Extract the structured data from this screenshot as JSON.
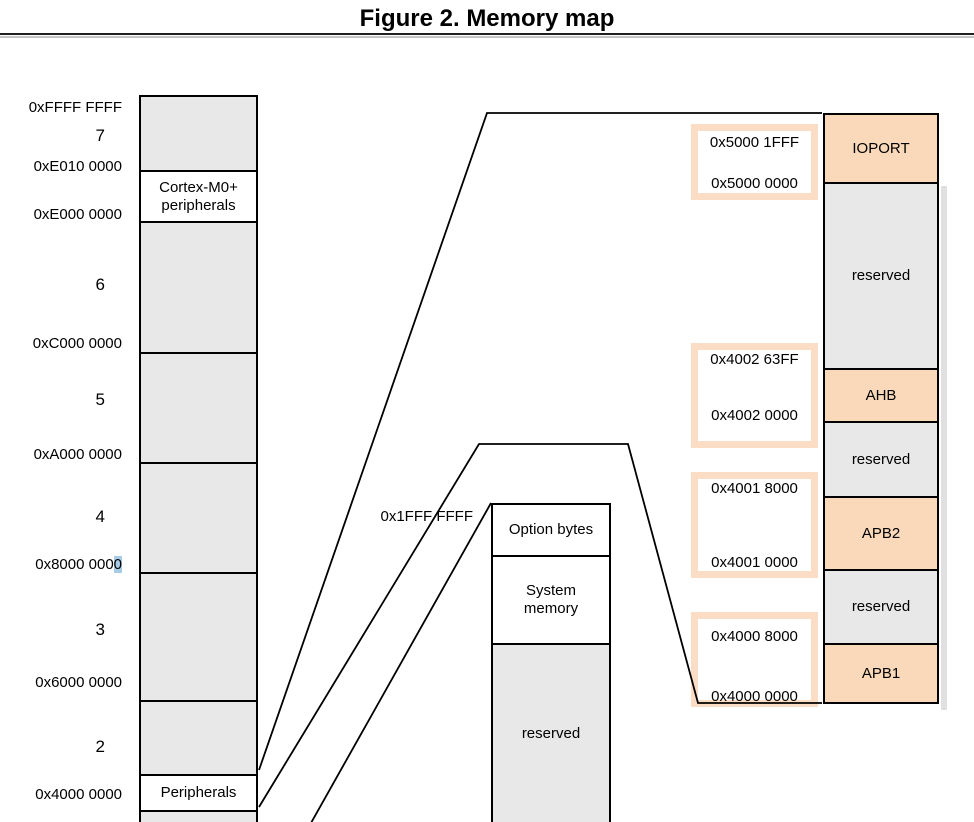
{
  "figure": {
    "title": "Figure 2. Memory map"
  },
  "colors": {
    "block_gray": "#e8e8e8",
    "block_peach": "#fad8ba",
    "address_box_border": "#fbdcc4",
    "selection_highlight": "#a9cce6"
  },
  "left_column": {
    "addresses": {
      "ffff": "0xFFFF FFFF",
      "e010": "0xE010 0000",
      "e000": "0xE000 0000",
      "c000": "0xC000 0000",
      "a000": "0xA000 0000",
      "a8000_prefix": "0x8000 000",
      "a8000_highlight": "0",
      "a6000": "0x6000 0000",
      "a4000": "0x4000 0000"
    },
    "region_numbers": {
      "r7": "7",
      "r6": "6",
      "r5": "5",
      "r4": "4",
      "r3": "3",
      "r2": "2"
    },
    "blocks": {
      "cortex": "Cortex-M0+ peripherals",
      "peripherals": "Peripherals"
    }
  },
  "middle_column": {
    "address": "0x1FFF FFFF",
    "blocks": {
      "option_bytes": "Option bytes",
      "system_memory": "System memory",
      "reserved": "reserved"
    }
  },
  "right_column": {
    "blocks": {
      "ioport": "IOPORT",
      "reserved1": "reserved",
      "ahb": "AHB",
      "reserved2": "reserved",
      "apb2": "APB2",
      "reserved3": "reserved",
      "apb1": "APB1"
    }
  },
  "address_boxes": [
    {
      "top": "0x5000 1FFF",
      "bottom": "0x5000 0000"
    },
    {
      "top": "0x4002 63FF",
      "bottom": "0x4002 0000"
    },
    {
      "top": "0x4001 8000",
      "bottom": "0x4001 0000"
    },
    {
      "top": "0x4000 8000",
      "bottom": "0x4000 0000"
    }
  ]
}
